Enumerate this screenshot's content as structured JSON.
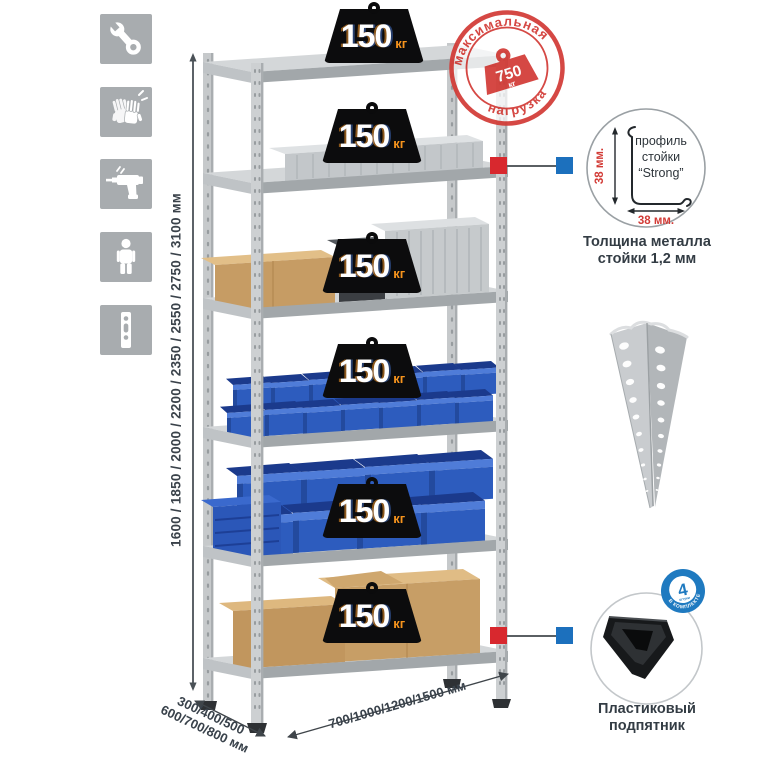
{
  "sidebar": {
    "icons": [
      {
        "name": "wrench-icon"
      },
      {
        "name": "gloves-icon"
      },
      {
        "name": "drill-icon"
      },
      {
        "name": "person-icon"
      },
      {
        "name": "upright-profile-icon"
      }
    ]
  },
  "dims": {
    "height_label": "1600 / 1850 / 2000 / 2200 / 2350 / 2550 / 2750 / 3100 мм",
    "depth_line1": "300/400/500",
    "depth_line2": "600/700/800 мм",
    "width_label": "700/1000/1200/1500 мм"
  },
  "badges": [
    {
      "value": "150",
      "unit": "кг"
    },
    {
      "value": "150",
      "unit": "кг"
    },
    {
      "value": "150",
      "unit": "кг"
    },
    {
      "value": "150",
      "unit": "кг"
    },
    {
      "value": "150",
      "unit": "кг"
    },
    {
      "value": "150",
      "unit": "кг"
    }
  ],
  "stamp": {
    "top_text": "максимальная",
    "bottom_text": "нагрузка",
    "value": "750",
    "unit": "кг"
  },
  "profile": {
    "label1": "профиль",
    "label2": "стойки",
    "label3": "“Strong”",
    "dim_vertical": "38 мм.",
    "dim_horizontal": "38 мм.",
    "caption_line1": "Толщина металла",
    "caption_line2": "стойки 1,2 мм"
  },
  "foot": {
    "badge_value": "4",
    "badge_sub": "штуки",
    "badge_arc": "в комплекте",
    "caption_line1": "Пластиковый",
    "caption_line2": "подпятник"
  },
  "colors": {
    "stamp_red": "#d23b36",
    "connector_red": "#d8282e",
    "connector_blue": "#1c70bd",
    "badge_unit_orange": "#f7941d",
    "bin_blue": "#2d5cbe",
    "icon_bg": "#a8acaf"
  }
}
